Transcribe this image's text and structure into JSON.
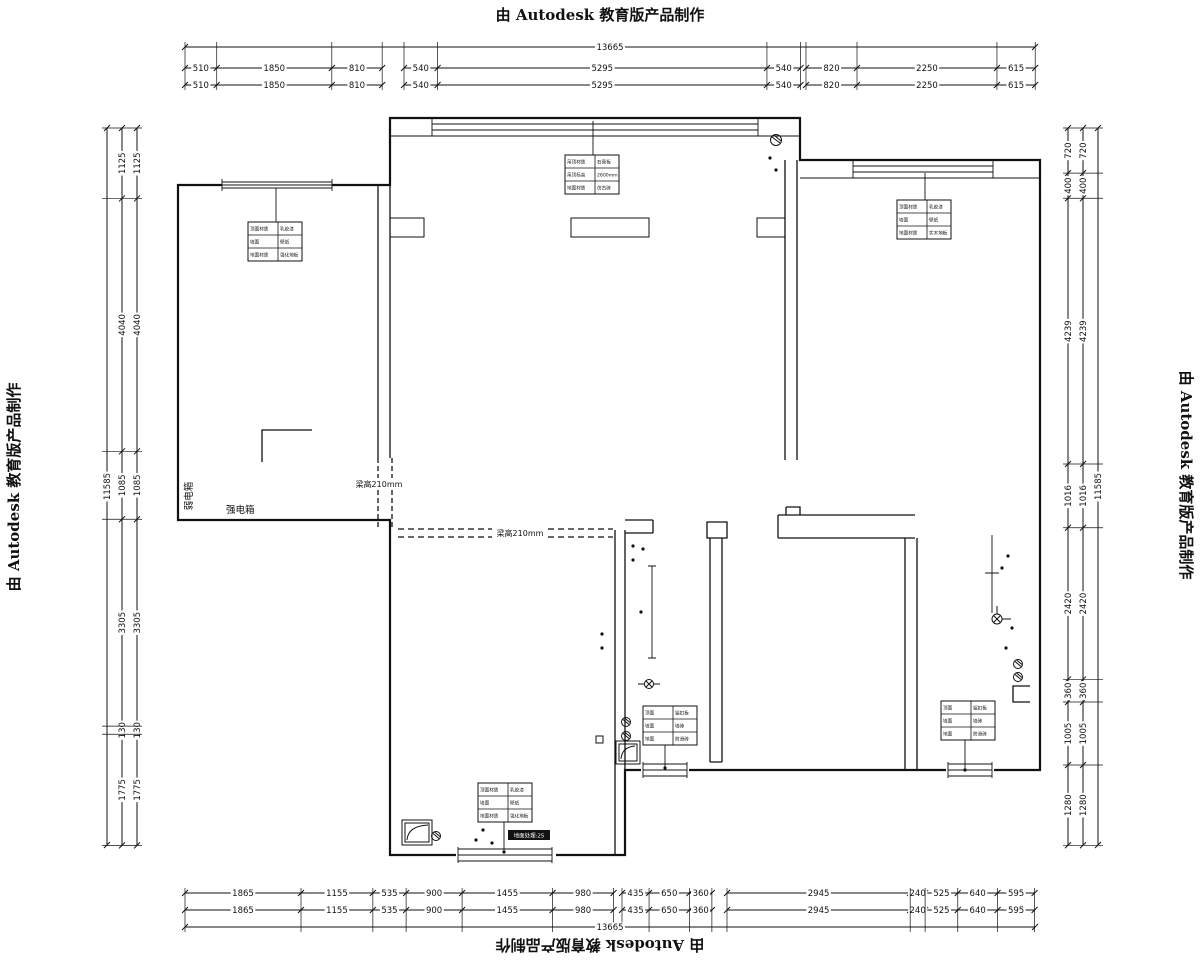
{
  "stamp": {
    "text": "由 Autodesk 教育版产品制作"
  },
  "dimensions": {
    "top": {
      "total": "13665",
      "groups": [
        [
          "510",
          "1850",
          "810"
        ],
        [
          "540",
          "5295",
          "540"
        ],
        [
          "820",
          "2250",
          "615"
        ]
      ]
    },
    "bottom": {
      "total": "13665",
      "groups": [
        [
          "1865",
          "1155",
          "535",
          "900",
          "1455",
          "980"
        ],
        [
          "435",
          "650",
          "360"
        ],
        [
          "2945",
          "240",
          "525",
          "640",
          "595"
        ]
      ]
    },
    "left": {
      "total": "11585",
      "groups": [
        [
          "1125",
          "4040",
          "1085",
          "3305",
          "130",
          "1775"
        ]
      ]
    },
    "right": {
      "total": "11585",
      "groups": [
        [
          "720",
          "400",
          "4239",
          "1016",
          "2420",
          "360",
          "1005",
          "1280"
        ]
      ]
    }
  },
  "plan_labels": {
    "strong_electric_box": "强电箱",
    "weak_electric_box": "弱电箱",
    "beam_note_1": "梁高210mm",
    "beam_note_2": "梁高210mm",
    "floor_note": "地面处理:25"
  },
  "legend_tables": [
    {
      "name": "bedroom-1-legend",
      "rows": [
        [
          "顶面材质",
          "乳胶漆"
        ],
        [
          "墙面",
          "壁纸"
        ],
        [
          "地面材质",
          "强化地板"
        ]
      ]
    },
    {
      "name": "living-room-legend",
      "rows": [
        [
          "吊顶材质",
          "石膏板"
        ],
        [
          "吊顶标高",
          "2600mm"
        ],
        [
          "地面材质",
          "仿古砖"
        ]
      ]
    },
    {
      "name": "bedroom-2-legend",
      "rows": [
        [
          "顶面材质",
          "乳胶漆"
        ],
        [
          "墙面",
          "壁纸"
        ],
        [
          "地面材质",
          "实木地板"
        ]
      ]
    },
    {
      "name": "master-bedroom-legend",
      "rows": [
        [
          "顶面材质",
          "乳胶漆"
        ],
        [
          "墙面",
          "壁纸"
        ],
        [
          "地面材质",
          "强化地板"
        ]
      ]
    },
    {
      "name": "bathroom-legend",
      "rows": [
        [
          "顶面",
          "铝扣板"
        ],
        [
          "墙面",
          "墙砖"
        ],
        [
          "地面",
          "防滑砖"
        ]
      ]
    },
    {
      "name": "kitchen-legend",
      "rows": [
        [
          "顶面",
          "铝扣板"
        ],
        [
          "墙面",
          "墙砖"
        ],
        [
          "地面",
          "防滑砖"
        ]
      ]
    }
  ]
}
